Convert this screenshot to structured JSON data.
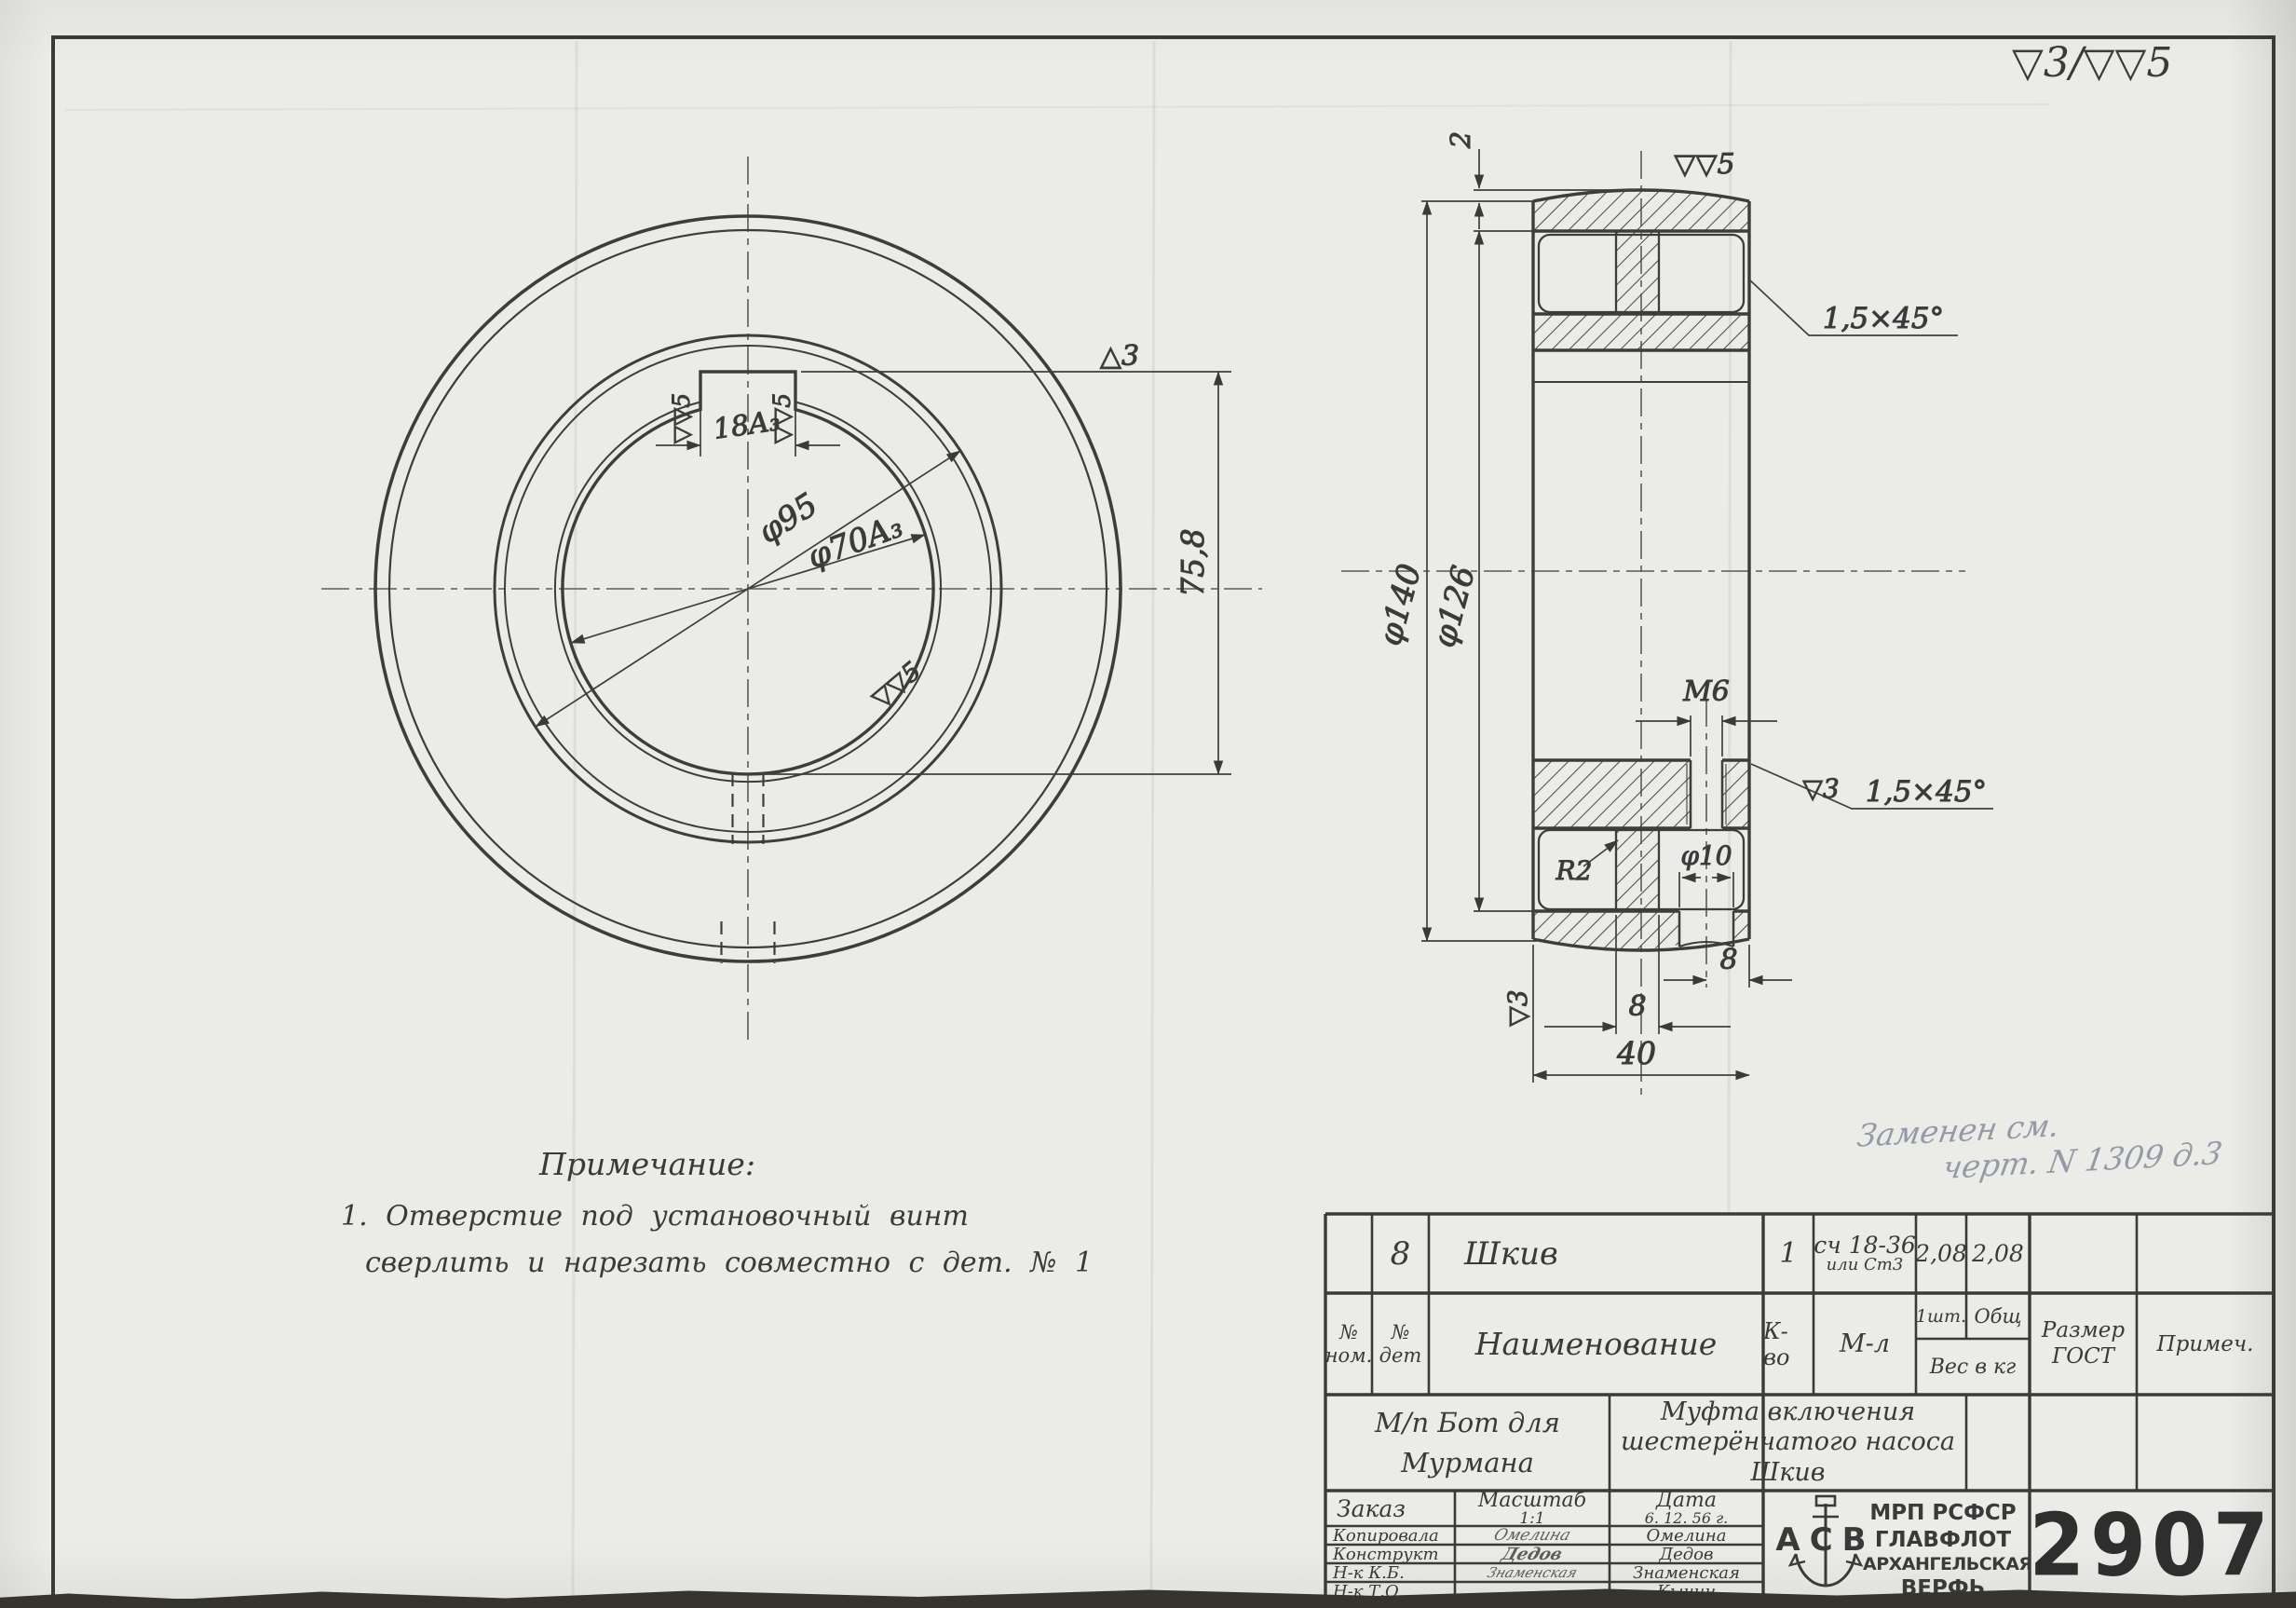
{
  "sheet": {
    "corner_finish_note": "▽3/▽▽5",
    "pencil_note_line1": "Заменен см.",
    "pencil_note_line2": "черт. N 1309 д.3"
  },
  "front_view": {
    "hub_diameter": "φ95",
    "bore_diameter": "φ70A₃",
    "keyway_width": "18A₃",
    "keyway_height": "75,8",
    "face_mark": "△3",
    "keyway_side_mark_left": "▽▽5",
    "keyway_side_mark_right": "▽▽5",
    "bore_mark": "▽▽5"
  },
  "section_view": {
    "crown_height": "2",
    "outer_diameter": "φ140",
    "rim_inner_diameter": "φ126",
    "face_finish_mark": "▽▽5",
    "rim_chamfer": "1,5×45°",
    "setscrew_thread": "M6",
    "bore_chamfer_mark": "▽3",
    "bore_chamfer": "1,5×45°",
    "fillet_radius": "R2",
    "access_hole_diameter": "φ10",
    "web_thickness": "8",
    "hole_offset": "8",
    "overall_width": "40",
    "side_face_mark": "▽3"
  },
  "notes": {
    "title": "Примечание:",
    "line1": "1.  Отверстие  под  установочный  винт",
    "line2": "сверлить  и  нарезать  совместно  с  дет. № 1"
  },
  "title_block": {
    "row_part": {
      "num_det": "8",
      "name": "Шкив",
      "qty": "1",
      "material_line1": "сч 18-36",
      "material_line2": "или Ст3",
      "weight_unit": "2,08",
      "weight_total": "2,08"
    },
    "headers": {
      "col_num_top": "№",
      "col_num_bottom": "ном.",
      "col_det_top": "№",
      "col_det_bottom": "дет",
      "name": "Наименование",
      "qty": "К-во",
      "material": "М-л",
      "per_item": "1шт.",
      "total": "Общ",
      "weight": "Вес в кг",
      "size_top": "Размер",
      "size_bottom": "ГОСТ",
      "note": "Примеч."
    },
    "project": {
      "line1": "М/п Бот для",
      "line2": "Мурмана"
    },
    "part_title": {
      "line1": "Муфта включения",
      "line2": "шестерёнчатого насоса",
      "line3": "Шкив"
    },
    "order": {
      "label": "Заказ",
      "scale_label": "Масштаб",
      "scale_value": "1:1",
      "date_label": "Дата",
      "date_value": "6. 12. 56 г."
    },
    "signatures": [
      {
        "role": "Копировала",
        "signature": "Омелина",
        "name": "Омелина"
      },
      {
        "role": "Конструкт",
        "signature": "Дедов",
        "name": "Дедов"
      },
      {
        "role": "Н-к  К.Б.",
        "signature": "Знаменская",
        "name": "Знаменская"
      },
      {
        "role": "Н-к  Т.О",
        "signature": "",
        "name": "Кычин"
      }
    ],
    "org": {
      "logo_letters": "АСВ",
      "line1": "МРП РСФСР",
      "line2": "ГЛАВФЛОТ",
      "line3": "АРХАНГЕЛЬСКАЯ",
      "line4": "ВЕРФЬ"
    },
    "drawing_number": "2907"
  }
}
